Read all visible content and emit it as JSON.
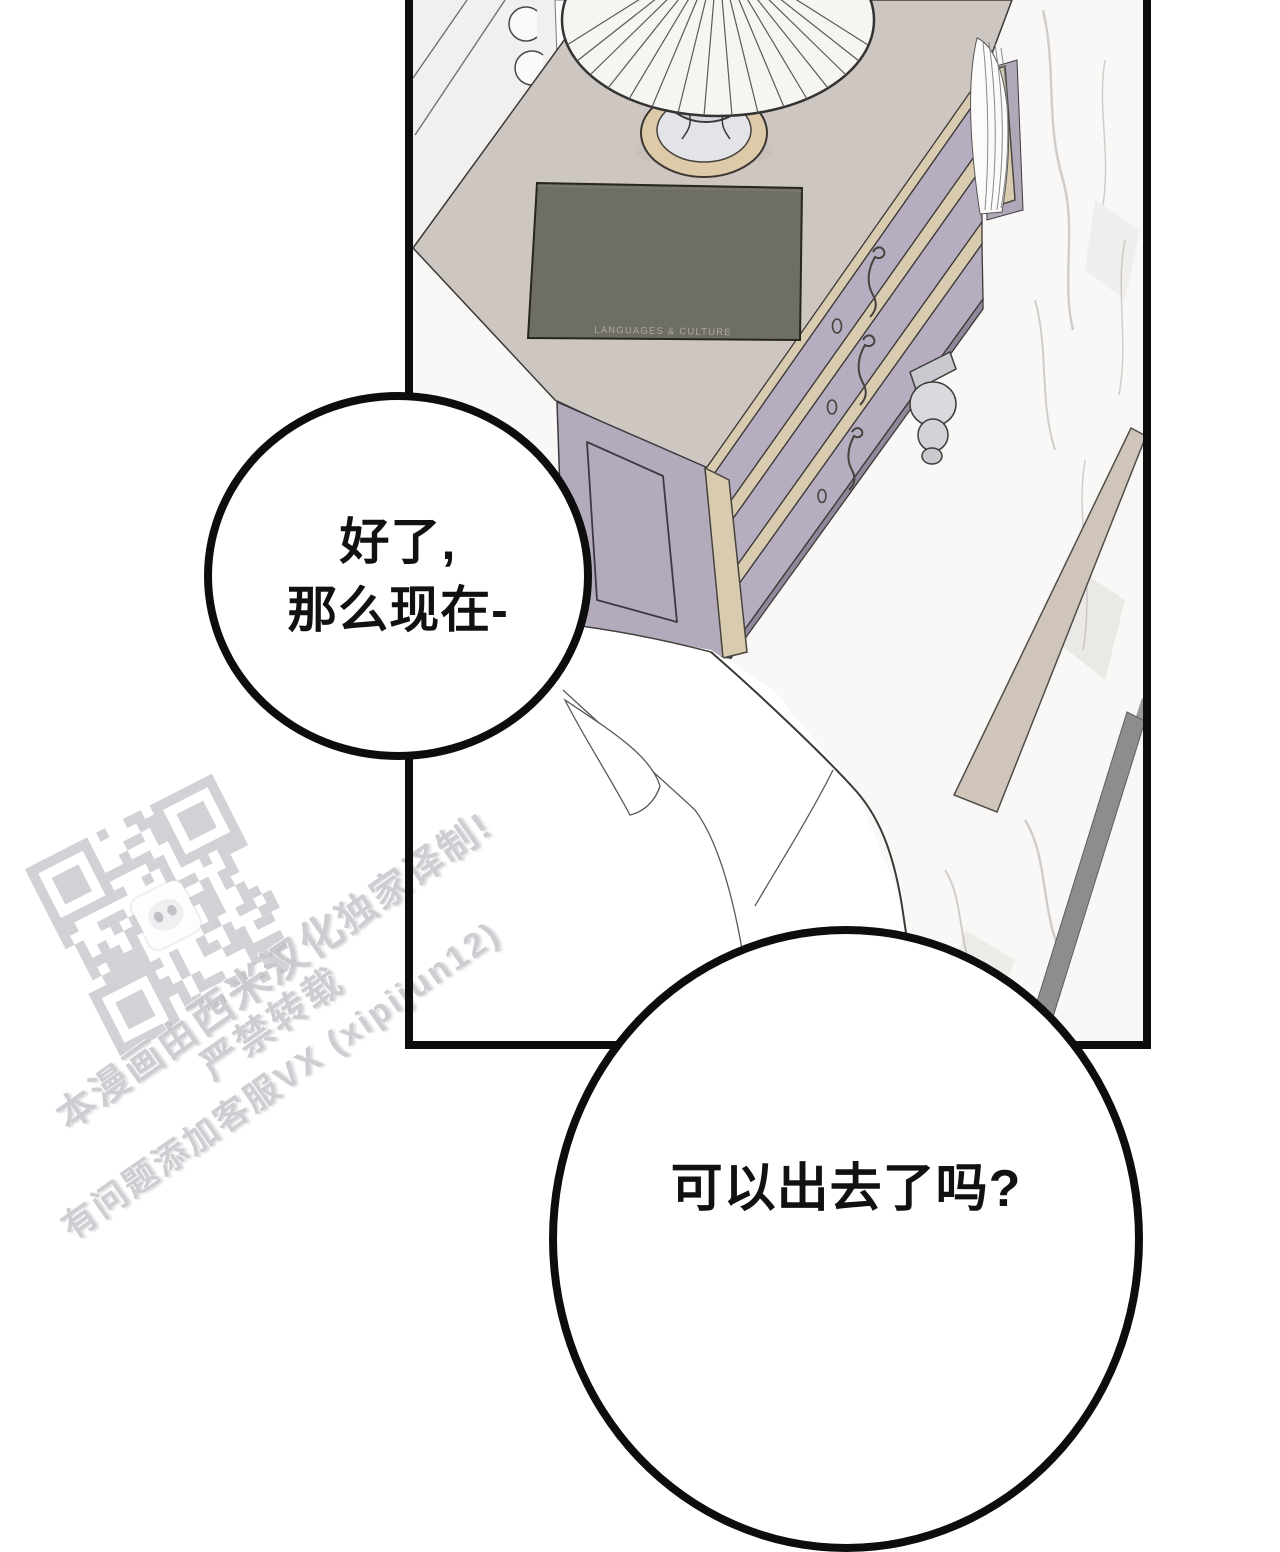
{
  "page": {
    "kind": "webtoon comic page",
    "panel_count": "1"
  },
  "bubbles": {
    "bubble1": {
      "line1": "好了,",
      "line2": "那么现在-"
    },
    "bubble2": {
      "line1": "可以出去了吗?"
    }
  },
  "scene": {
    "book_spine_text": "LANGUAGES & CULTURE",
    "objects": [
      "pleated-table-lamp",
      "hardcover-book",
      "classical-three-drawer-dresser",
      "white-bed-sheets",
      "marble-floor",
      "wall-molding-with-scrolls",
      "floor-stripe",
      "curtain-drape"
    ]
  },
  "watermark": {
    "qr_icon": "qr-code",
    "line1_pre": "本漫画由",
    "line1_brand": "西米汉化",
    "line1_post": "独家译制!",
    "line2": "严禁转载",
    "line3": "有问题添加客服VX (xipijun12)"
  },
  "colors": {
    "panel_border": "#0d0d0d",
    "bubble_fill": "#ffffff",
    "bubble_stroke": "#0d0d0d",
    "text_black": "#111111",
    "watermark_gray": "#c9c9ce",
    "qr_gray": "#b6b6be",
    "dresser_top": "#cdc6c1",
    "drawer_front": "#b6aec0",
    "trim_tan": "#d8cbb0",
    "book_cover": "#6f6e66",
    "marble": "#f9f8f7",
    "floor_stripe_tan": "#cfc5ba",
    "floor_stripe_gray": "#8d8d8d"
  }
}
